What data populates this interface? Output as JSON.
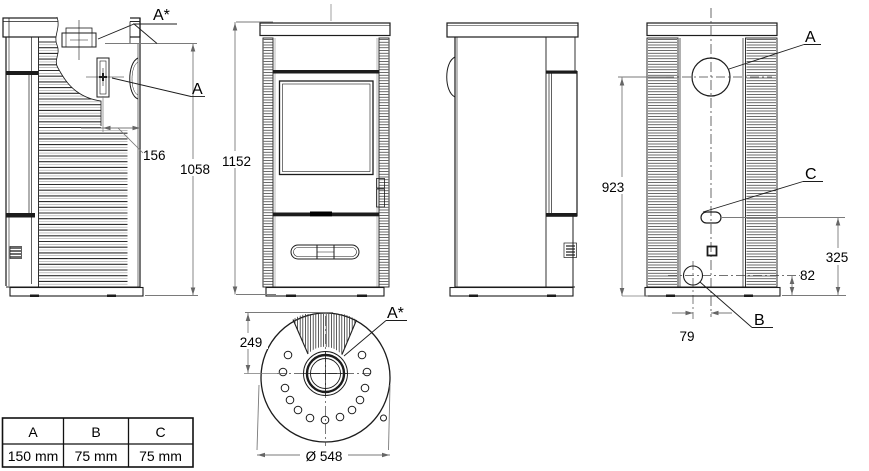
{
  "drawing": {
    "title": "stove-technical-drawing",
    "side_view": {
      "label_a_star": "A*",
      "label_a": "A",
      "dim_offset": "156",
      "dim_outlet_height": "1058"
    },
    "front_view": {
      "dim_total_height": "1152"
    },
    "back_view": {
      "label_a": "A",
      "label_b": "B",
      "label_c": "C",
      "dim_a_height": "923",
      "dim_c_height": "325",
      "dim_b_height": "82",
      "dim_b_offset": "79"
    },
    "top_view": {
      "label_a_star": "A*",
      "dim_collar_offset": "249",
      "dim_diameter": "Ø 548"
    }
  },
  "table": {
    "headers": [
      "A",
      "B",
      "C"
    ],
    "values": [
      "150 mm",
      "75 mm",
      "75 mm"
    ]
  },
  "colors": {
    "line": "#1c1c1c",
    "dim_line": "#7a7a7a",
    "text": "#000000",
    "background": "#ffffff"
  }
}
